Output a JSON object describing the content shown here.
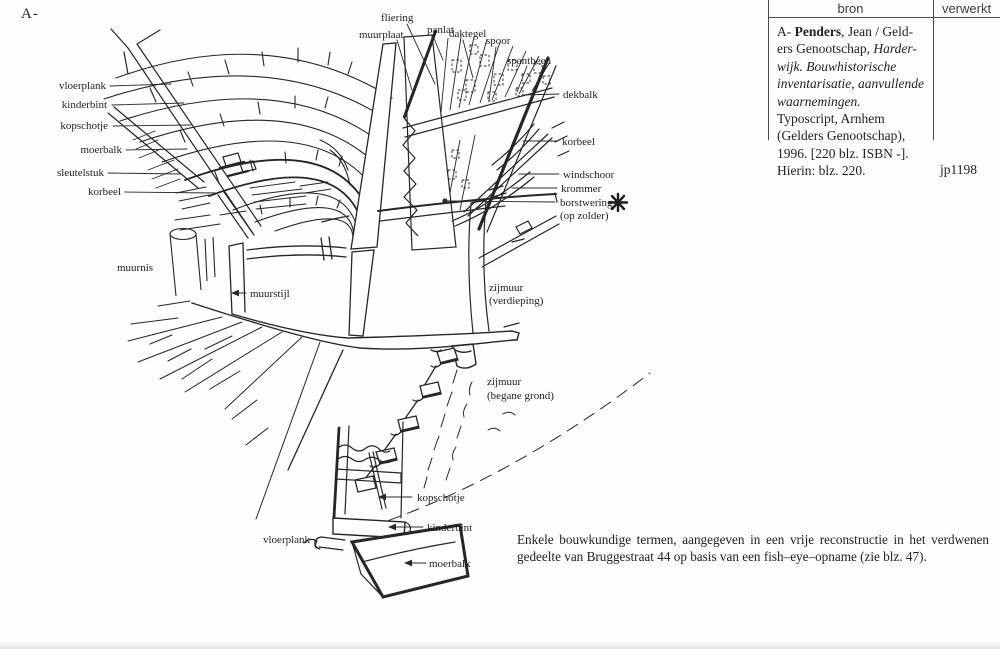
{
  "page": {
    "marker": "A-"
  },
  "table": {
    "header": {
      "bron": "bron",
      "verwerkt": "verwerkt"
    },
    "entry": {
      "l1a": "A- ",
      "l1b": "Penders",
      "l1c": ", Jean / Geld-",
      "l2a": "ers Genootschap, ",
      "l2b": "Harder-",
      "l3": "wijk. Bouwhistorische",
      "l4": "inventarisatie, aanvullende",
      "l5": "waarnemingen.",
      "l6": "Typoscript, Arnhem",
      "l7": "(Gelders Genootschap),",
      "l8": "1996. [220 blz. ISBN -].",
      "l9": "Hierin: blz. 220."
    },
    "code": "jp1198"
  },
  "caption": {
    "line1": "Enkele bouwkundige termen, aangegeven in een vrije reconstructie in het verdwenen",
    "line2": "gedeelte van Bruggestraat 44 op basis van een fish–eye–opname (zie blz. 47)."
  },
  "figure": {
    "icons": {
      "star": "asterisk-icon"
    },
    "labels": {
      "vloerplank_top": "vloerplank",
      "kinderbint_top": "kinderbint",
      "kopschotje_top": "kopschotje",
      "moerbalk_top": "moerbalk",
      "sleutelstuk": "sleutelstuk",
      "korbeel_left": "korbeel",
      "fliering": "fliering",
      "muurplaat": "muurplaat",
      "panlat": "panlat",
      "daktegel": "daktegel",
      "spoor": "spoor",
      "spantbeen": "spantbeen",
      "dekbalk": "dekbalk",
      "korbeel_right": "korbeel",
      "windschoor": "windschoor",
      "krommer": "krommer",
      "borstwering1": "borstwering",
      "borstwering2": "(op zolder)",
      "muurnis": "muurnis",
      "muurstijl": "muurstijl",
      "zijmuur_v1": "zijmuur",
      "zijmuur_v2": "(verdieping)",
      "zijmuur_b1": "zijmuur",
      "zijmuur_b2": "(begane grond)",
      "kopschotje_bottom": "kopschotje",
      "kinderbint_bottom": "kinderbint",
      "vloerplank_bottom": "vloerplank",
      "moerbalk_bottom": "moerbalk"
    }
  }
}
